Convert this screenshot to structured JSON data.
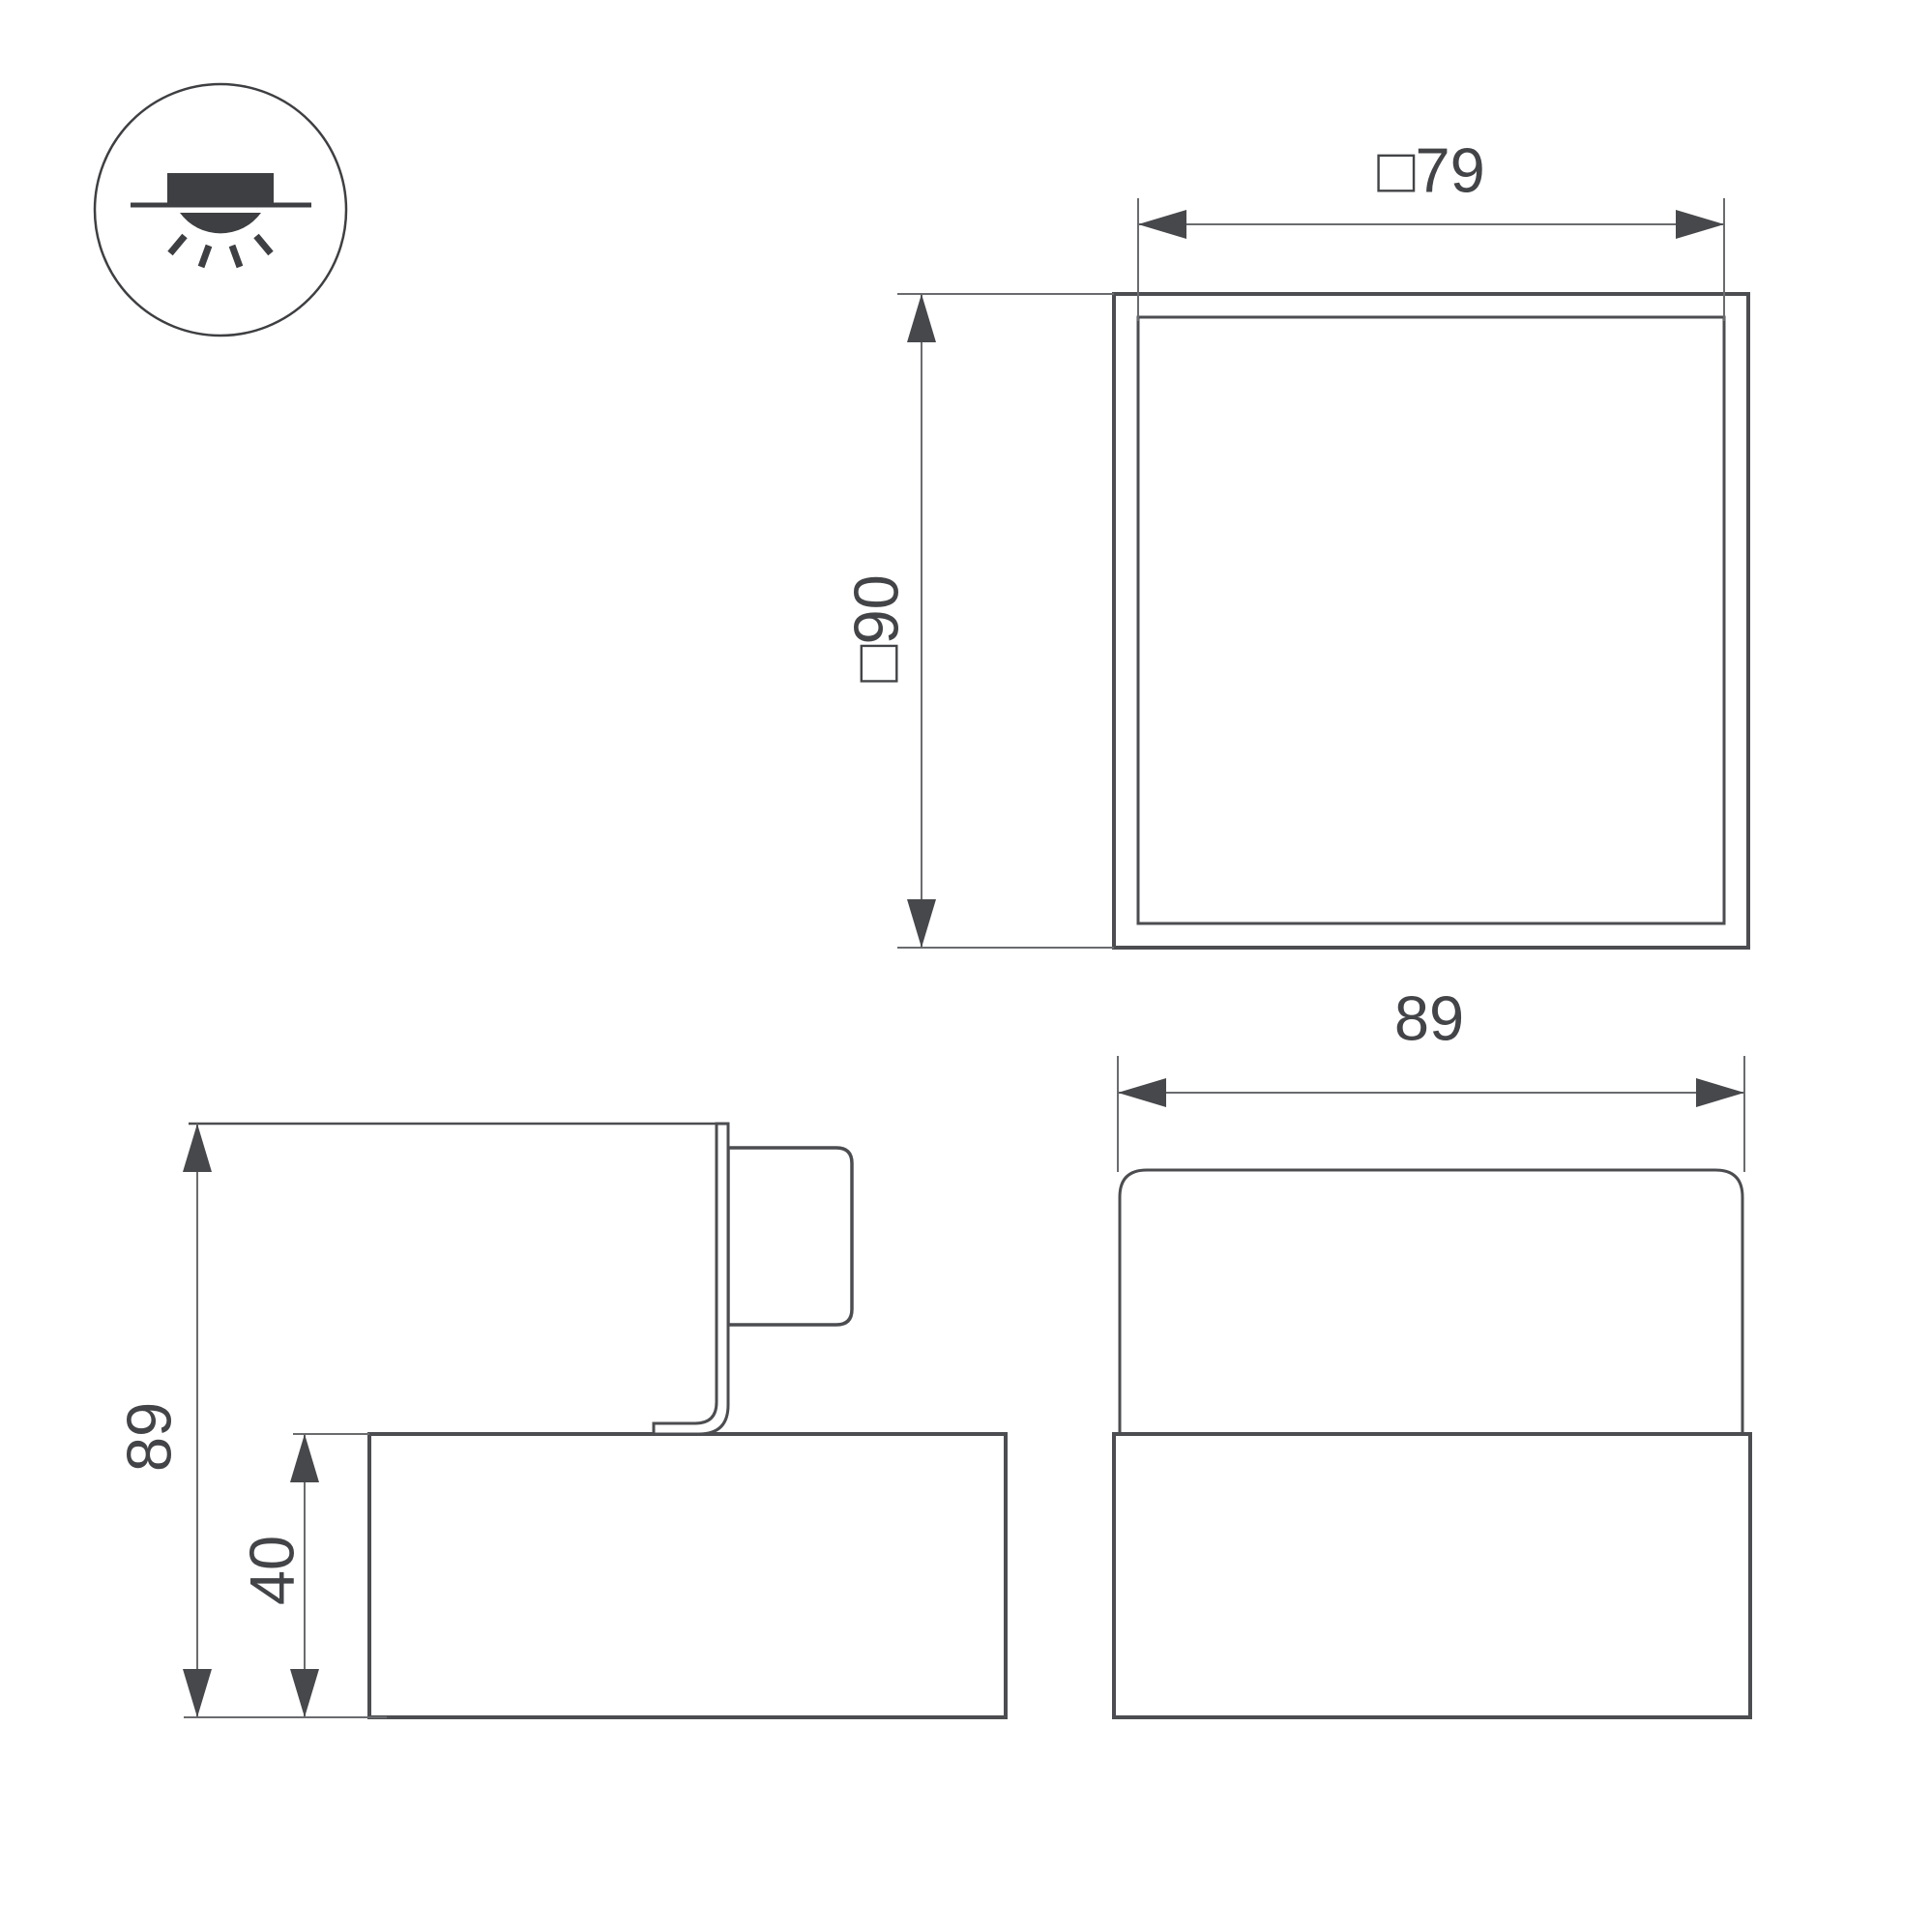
{
  "drawing": {
    "background": "#ffffff",
    "colors": {
      "line": "#4c4d50",
      "thin": "#6a6b6e",
      "arrow": "#47484b",
      "text": "#434447",
      "dark": "#3e3f42"
    },
    "mount_icon": {
      "name": "surface-mounted-downlight-icon"
    },
    "top_view": {
      "width_dim_label": "□79",
      "height_dim_label": "□90"
    },
    "side_view": {
      "overall_height_dim_label": "89",
      "base_height_dim_label": "40"
    },
    "front_view": {
      "width_dim_label": "89"
    }
  }
}
